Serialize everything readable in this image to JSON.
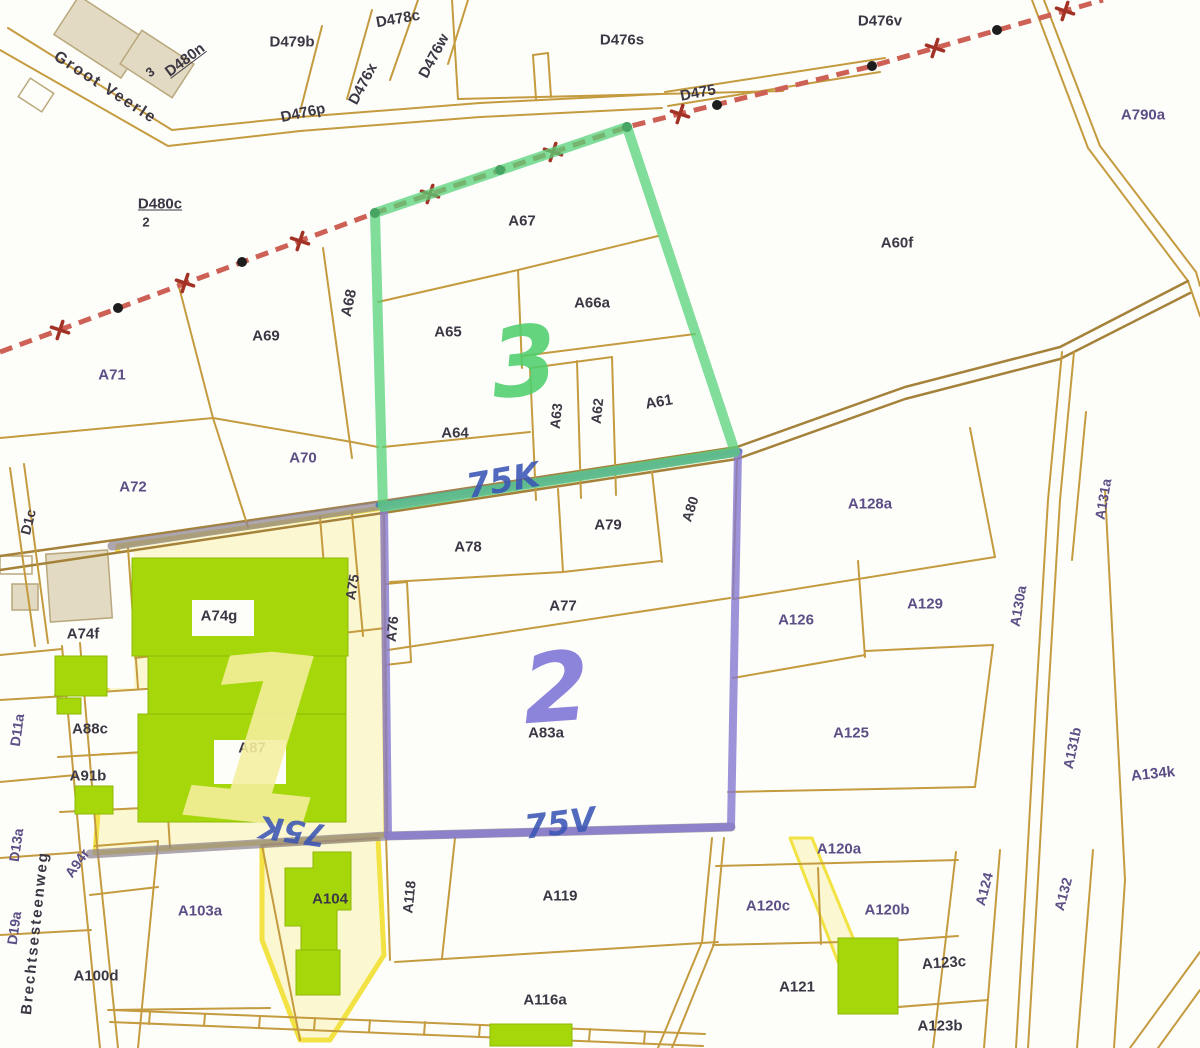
{
  "map": {
    "type": "cadastral-parcel-map",
    "railway_label": "D475",
    "street_names": [
      "Groot Veerle",
      "Brechtsesteenweg"
    ],
    "highlighted_region_numbers": [
      "1",
      "2",
      "3"
    ],
    "handwritten_annotations": [
      "75K",
      "75V",
      "75K"
    ],
    "colors": {
      "bg": "#fdfdfa",
      "line": "#c49b3f",
      "line_dark": "#a5823a",
      "y_fill": "#fbf7d0",
      "y_border": "#f2e243",
      "beige": "#e2dac2",
      "beige_o": "#b9a87c",
      "green_b": "#a6d70b",
      "green_bo": "#8fba06",
      "rail": "#cd6156",
      "rail_dot": "#1d1d1d",
      "rail_x": "#a33226",
      "band": "#8e8490",
      "blue": "#3f7fb0",
      "purple": "#8578cf",
      "green": "#57d17a",
      "label_dark": "#3c3744",
      "label_purple": "#5d4f86",
      "ink_blue": "#3b56b5",
      "ink_green": "#4fcf6e",
      "ink_purple": "#7d74d6",
      "ink_yellow": "#f6f0a0"
    },
    "labels": [
      {
        "t": "D479b",
        "x": 292,
        "y": 42,
        "r": 0,
        "c": "label_dark",
        "s": 15,
        "k": "parcel"
      },
      {
        "t": "D478c",
        "x": 398,
        "y": 19,
        "r": -10,
        "c": "label_dark",
        "s": 15,
        "k": "parcel"
      },
      {
        "t": "D476w",
        "x": 434,
        "y": 56,
        "r": -62,
        "c": "label_dark",
        "s": 15,
        "k": "parcel"
      },
      {
        "t": "D476x",
        "x": 363,
        "y": 84,
        "r": -62,
        "c": "label_dark",
        "s": 15,
        "k": "parcel"
      },
      {
        "t": "D476p",
        "x": 303,
        "y": 113,
        "r": -12,
        "c": "label_dark",
        "s": 15,
        "k": "parcel"
      },
      {
        "t": "D480n",
        "x": 185,
        "y": 60,
        "r": -37,
        "c": "label_dark",
        "s": 15,
        "k": "parcel",
        "u": 1
      },
      {
        "t": "3",
        "x": 150,
        "y": 72,
        "r": -37,
        "c": "label_dark",
        "s": 13,
        "k": "lot-number"
      },
      {
        "t": "D476s",
        "x": 622,
        "y": 40,
        "r": 0,
        "c": "label_dark",
        "s": 15,
        "k": "parcel"
      },
      {
        "t": "D475",
        "x": 698,
        "y": 93,
        "r": -11,
        "c": "label_dark",
        "s": 15,
        "k": "road"
      },
      {
        "t": "D476v",
        "x": 880,
        "y": 21,
        "r": 0,
        "c": "label_dark",
        "s": 15,
        "k": "parcel"
      },
      {
        "t": "A790a",
        "x": 1143,
        "y": 115,
        "r": 0,
        "c": "label_purple",
        "s": 15,
        "k": "parcel"
      },
      {
        "t": "D480c",
        "x": 160,
        "y": 204,
        "r": 0,
        "c": "label_dark",
        "s": 15,
        "k": "parcel",
        "u": 1
      },
      {
        "t": "2",
        "x": 146,
        "y": 222,
        "r": 0,
        "c": "label_dark",
        "s": 13,
        "k": "lot-number"
      },
      {
        "t": "A67",
        "x": 522,
        "y": 221,
        "r": 0,
        "c": "label_dark",
        "s": 15,
        "k": "parcel"
      },
      {
        "t": "A68",
        "x": 349,
        "y": 303,
        "r": -78,
        "c": "label_dark",
        "s": 15,
        "k": "parcel"
      },
      {
        "t": "A69",
        "x": 266,
        "y": 336,
        "r": 0,
        "c": "label_dark",
        "s": 15,
        "k": "parcel"
      },
      {
        "t": "A71",
        "x": 112,
        "y": 375,
        "r": 0,
        "c": "label_purple",
        "s": 15,
        "k": "parcel"
      },
      {
        "t": "A65",
        "x": 448,
        "y": 332,
        "r": 0,
        "c": "label_dark",
        "s": 15,
        "k": "parcel"
      },
      {
        "t": "A66a",
        "x": 592,
        "y": 303,
        "r": 0,
        "c": "label_dark",
        "s": 15,
        "k": "parcel"
      },
      {
        "t": "A63",
        "x": 556,
        "y": 416,
        "r": -84,
        "c": "label_dark",
        "s": 14,
        "k": "parcel"
      },
      {
        "t": "A62",
        "x": 597,
        "y": 411,
        "r": -84,
        "c": "label_dark",
        "s": 14,
        "k": "parcel"
      },
      {
        "t": "A61",
        "x": 659,
        "y": 402,
        "r": -10,
        "c": "label_dark",
        "s": 15,
        "k": "parcel"
      },
      {
        "t": "A64",
        "x": 455,
        "y": 433,
        "r": 0,
        "c": "label_dark",
        "s": 15,
        "k": "parcel"
      },
      {
        "t": "A70",
        "x": 303,
        "y": 458,
        "r": 0,
        "c": "label_purple",
        "s": 15,
        "k": "parcel"
      },
      {
        "t": "A72",
        "x": 133,
        "y": 487,
        "r": 0,
        "c": "label_purple",
        "s": 15,
        "k": "parcel"
      },
      {
        "t": "A60f",
        "x": 897,
        "y": 243,
        "r": 0,
        "c": "label_dark",
        "s": 15,
        "k": "parcel"
      },
      {
        "t": "A128a",
        "x": 870,
        "y": 504,
        "r": 0,
        "c": "label_purple",
        "s": 15,
        "k": "parcel"
      },
      {
        "t": "A131a",
        "x": 1103,
        "y": 499,
        "r": -80,
        "c": "label_purple",
        "s": 14,
        "k": "parcel"
      },
      {
        "t": "A78",
        "x": 468,
        "y": 547,
        "r": 0,
        "c": "label_dark",
        "s": 15,
        "k": "parcel"
      },
      {
        "t": "A79",
        "x": 608,
        "y": 525,
        "r": 0,
        "c": "label_dark",
        "s": 15,
        "k": "parcel"
      },
      {
        "t": "A80",
        "x": 690,
        "y": 509,
        "r": -72,
        "c": "label_dark",
        "s": 14,
        "k": "parcel"
      },
      {
        "t": "A77",
        "x": 563,
        "y": 606,
        "r": 0,
        "c": "label_dark",
        "s": 15,
        "k": "parcel"
      },
      {
        "t": "A76",
        "x": 392,
        "y": 629,
        "r": -84,
        "c": "label_dark",
        "s": 14,
        "k": "parcel"
      },
      {
        "t": "A75",
        "x": 352,
        "y": 587,
        "r": -80,
        "c": "label_dark",
        "s": 14,
        "k": "parcel"
      },
      {
        "t": "A74g",
        "x": 219,
        "y": 616,
        "r": 0,
        "c": "label_dark",
        "s": 15,
        "k": "parcel"
      },
      {
        "t": "A74f",
        "x": 83,
        "y": 634,
        "r": 0,
        "c": "label_dark",
        "s": 15,
        "k": "parcel"
      },
      {
        "t": "A88c",
        "x": 90,
        "y": 729,
        "r": 0,
        "c": "label_dark",
        "s": 15,
        "k": "parcel"
      },
      {
        "t": "A87",
        "x": 252,
        "y": 748,
        "r": 0,
        "c": "label_dark",
        "s": 15,
        "k": "parcel"
      },
      {
        "t": "A91b",
        "x": 88,
        "y": 776,
        "r": 0,
        "c": "label_dark",
        "s": 15,
        "k": "parcel"
      },
      {
        "t": "A126",
        "x": 796,
        "y": 620,
        "r": 0,
        "c": "label_purple",
        "s": 15,
        "k": "parcel"
      },
      {
        "t": "A129",
        "x": 925,
        "y": 604,
        "r": 0,
        "c": "label_purple",
        "s": 15,
        "k": "parcel"
      },
      {
        "t": "A130a",
        "x": 1018,
        "y": 606,
        "r": -80,
        "c": "label_purple",
        "s": 14,
        "k": "parcel"
      },
      {
        "t": "A125",
        "x": 851,
        "y": 733,
        "r": 0,
        "c": "label_purple",
        "s": 15,
        "k": "parcel"
      },
      {
        "t": "A131b",
        "x": 1072,
        "y": 748,
        "r": -78,
        "c": "label_purple",
        "s": 14,
        "k": "parcel"
      },
      {
        "t": "A134k",
        "x": 1153,
        "y": 774,
        "r": -6,
        "c": "label_purple",
        "s": 15,
        "k": "parcel"
      },
      {
        "t": "A83a",
        "x": 546,
        "y": 733,
        "r": 0,
        "c": "label_dark",
        "s": 15,
        "k": "parcel"
      },
      {
        "t": "A120a",
        "x": 839,
        "y": 849,
        "r": 0,
        "c": "label_purple",
        "s": 15,
        "k": "parcel"
      },
      {
        "t": "A124",
        "x": 984,
        "y": 889,
        "r": -75,
        "c": "label_purple",
        "s": 14,
        "k": "parcel"
      },
      {
        "t": "A132",
        "x": 1063,
        "y": 894,
        "r": -75,
        "c": "label_purple",
        "s": 14,
        "k": "parcel"
      },
      {
        "t": "A120c",
        "x": 768,
        "y": 906,
        "r": 0,
        "c": "label_purple",
        "s": 15,
        "k": "parcel"
      },
      {
        "t": "A120b",
        "x": 887,
        "y": 910,
        "r": 0,
        "c": "label_purple",
        "s": 15,
        "k": "parcel"
      },
      {
        "t": "A121",
        "x": 797,
        "y": 987,
        "r": 0,
        "c": "label_dark",
        "s": 15,
        "k": "parcel"
      },
      {
        "t": "A123c",
        "x": 944,
        "y": 963,
        "r": -4,
        "c": "label_dark",
        "s": 15,
        "k": "parcel"
      },
      {
        "t": "A123b",
        "x": 940,
        "y": 1026,
        "r": 0,
        "c": "label_dark",
        "s": 15,
        "k": "parcel"
      },
      {
        "t": "A119",
        "x": 560,
        "y": 896,
        "r": 0,
        "c": "label_dark",
        "s": 15,
        "k": "parcel"
      },
      {
        "t": "A118",
        "x": 409,
        "y": 897,
        "r": -84,
        "c": "label_dark",
        "s": 14,
        "k": "parcel"
      },
      {
        "t": "A104",
        "x": 330,
        "y": 899,
        "r": 0,
        "c": "label_dark",
        "s": 15,
        "k": "parcel"
      },
      {
        "t": "A103a",
        "x": 200,
        "y": 911,
        "r": 0,
        "c": "label_purple",
        "s": 15,
        "k": "parcel"
      },
      {
        "t": "A94r",
        "x": 77,
        "y": 863,
        "r": -55,
        "c": "label_purple",
        "s": 14,
        "k": "parcel"
      },
      {
        "t": "A100d",
        "x": 96,
        "y": 976,
        "r": 0,
        "c": "label_dark",
        "s": 15,
        "k": "parcel"
      },
      {
        "t": "A116a",
        "x": 545,
        "y": 1000,
        "r": 0,
        "c": "label_dark",
        "s": 15,
        "k": "parcel"
      },
      {
        "t": "D1c",
        "x": 28,
        "y": 522,
        "r": -76,
        "c": "label_dark",
        "s": 14,
        "k": "parcel"
      },
      {
        "t": "D11a",
        "x": 17,
        "y": 730,
        "r": -82,
        "c": "label_purple",
        "s": 14,
        "k": "parcel"
      },
      {
        "t": "D13a",
        "x": 16,
        "y": 845,
        "r": -82,
        "c": "label_purple",
        "s": 14,
        "k": "parcel"
      },
      {
        "t": "D19a",
        "x": 14,
        "y": 928,
        "r": -82,
        "c": "label_purple",
        "s": 14,
        "k": "parcel"
      },
      {
        "t": "Groot Veerle",
        "x": 105,
        "y": 88,
        "r": 33,
        "c": "label_dark",
        "s": 16,
        "k": "street"
      },
      {
        "t": "Brechtsesteenweg",
        "x": 35,
        "y": 933,
        "r": -84,
        "c": "label_dark",
        "s": 15,
        "k": "street"
      },
      {
        "t": "1",
        "x": 262,
        "y": 742,
        "r": 6,
        "c": "ink_yellow",
        "s": 235,
        "k": "ink"
      },
      {
        "t": "2",
        "x": 556,
        "y": 688,
        "r": -4,
        "c": "ink_purple",
        "s": 96,
        "k": "ink"
      },
      {
        "t": "3",
        "x": 524,
        "y": 362,
        "r": -6,
        "c": "ink_green",
        "s": 96,
        "k": "ink"
      },
      {
        "t": "75K",
        "x": 503,
        "y": 481,
        "r": -10,
        "c": "ink_blue",
        "s": 34,
        "k": "ink"
      },
      {
        "t": "75V",
        "x": 560,
        "y": 823,
        "r": -7,
        "c": "ink_blue",
        "s": 33,
        "k": "ink"
      },
      {
        "t": "75K",
        "x": 293,
        "y": 830,
        "r": 188,
        "c": "ink_blue",
        "s": 31,
        "k": "ink"
      }
    ]
  }
}
